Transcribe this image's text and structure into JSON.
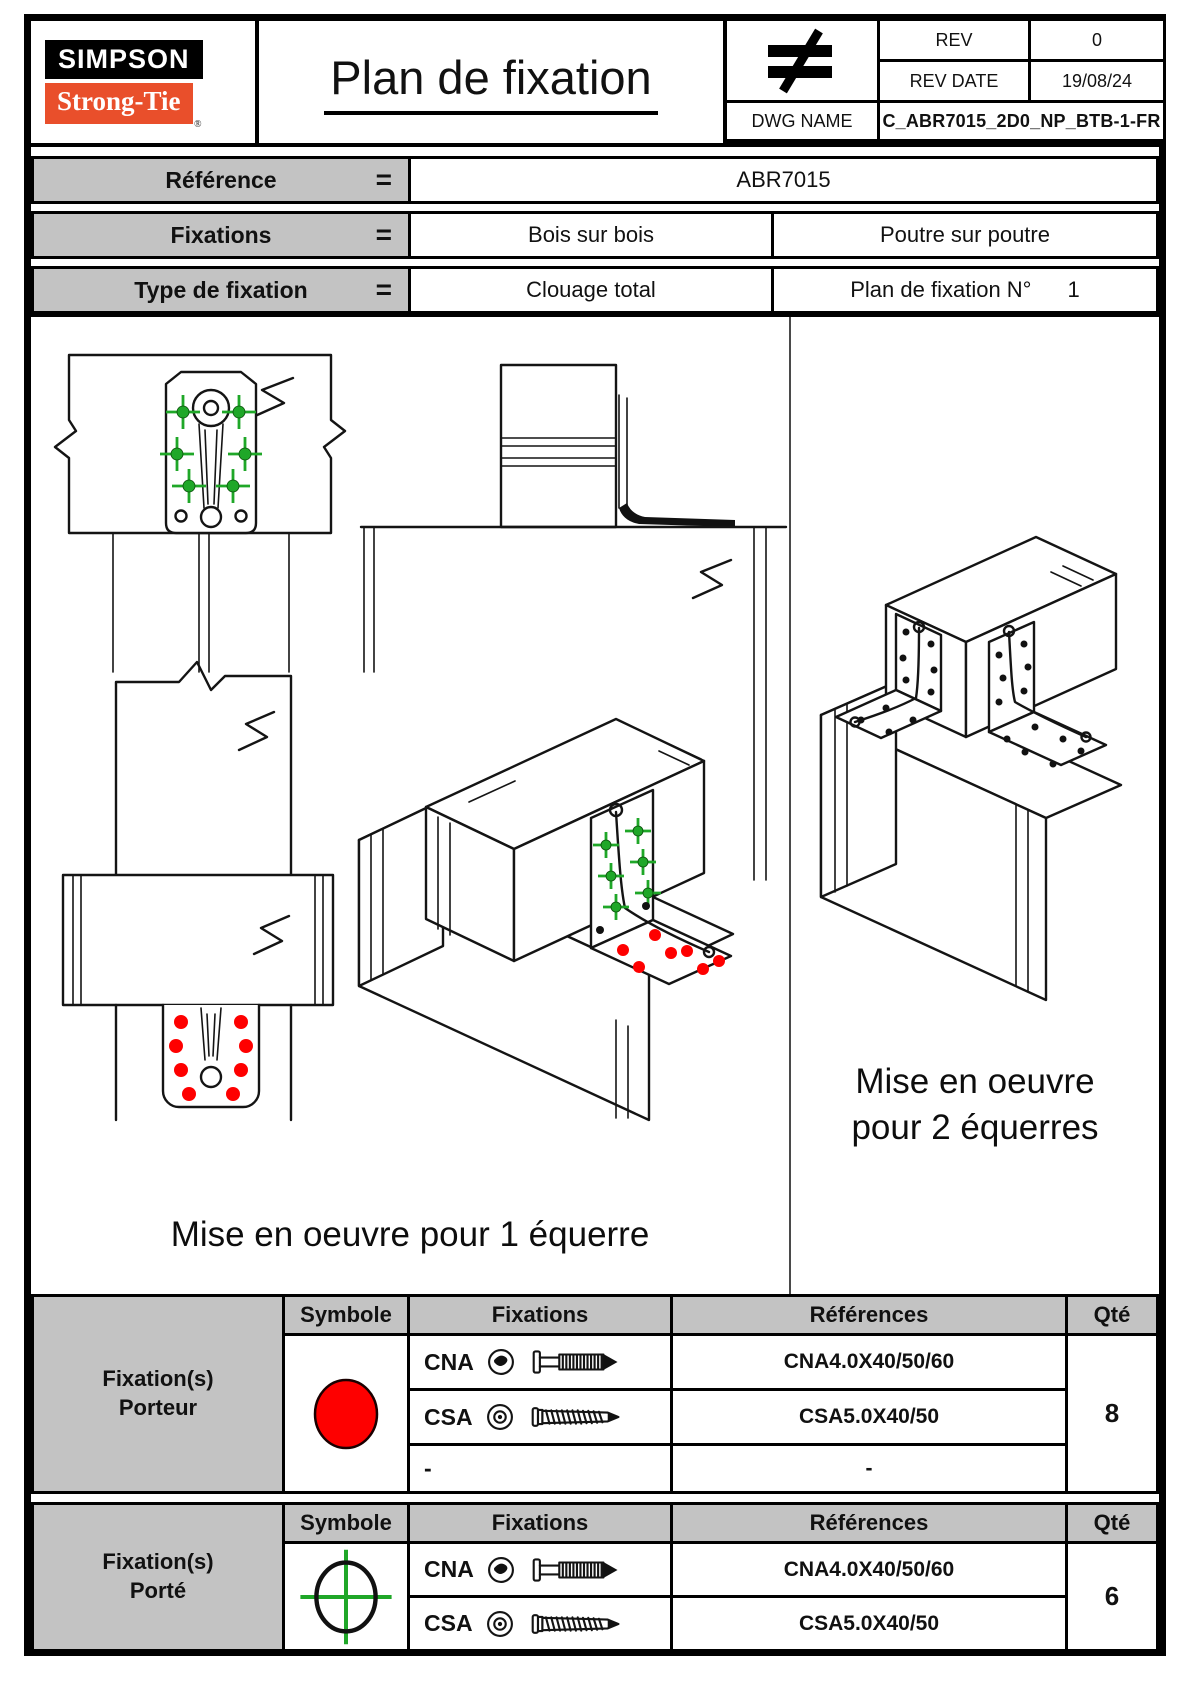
{
  "header": {
    "logo_top": "SIMPSON",
    "logo_bottom": "Strong-Tie",
    "logo_reg": "®",
    "title": "Plan de fixation",
    "revision_symbol": "≠",
    "rev_label": "REV",
    "rev_value": "0",
    "rev_date_label": "REV DATE",
    "rev_date_value": "19/08/24",
    "dwg_label": "DWG NAME",
    "dwg_value": "C_ABR7015_2D0_NP_BTB-1-FR"
  },
  "info": {
    "rows": [
      {
        "label": "Référence",
        "eq": "=",
        "values": [
          "ABR7015"
        ]
      },
      {
        "label": "Fixations",
        "eq": "=",
        "values": [
          "Bois sur bois",
          "Poutre sur poutre"
        ]
      },
      {
        "label": "Type de fixation",
        "eq": "=",
        "values": [
          "Clouage total"
        ],
        "extra_label": "Plan de fixation N°",
        "extra_value": "1"
      }
    ]
  },
  "drawings": {
    "caption_left": "Mise en oeuvre pour 1 équerre",
    "caption_right_line1": "Mise en oeuvre",
    "caption_right_line2": "pour 2 équerres"
  },
  "tables": [
    {
      "row_label_line1": "Fixation(s)",
      "row_label_line2": "Porteur",
      "headers": [
        "Symbole",
        "Fixations",
        "Références",
        "Qté"
      ],
      "symbol": "red-circle",
      "rows": [
        {
          "fix": "CNA",
          "ref": "CNA4.0X40/50/60"
        },
        {
          "fix": "CSA",
          "ref": "CSA5.0X40/50"
        },
        {
          "fix": "-",
          "ref": "-"
        }
      ],
      "qty": "8"
    },
    {
      "row_label_line1": "Fixation(s)",
      "row_label_line2": "Porté",
      "headers": [
        "Symbole",
        "Fixations",
        "Références",
        "Qté"
      ],
      "symbol": "green-crosshair",
      "rows": [
        {
          "fix": "CNA",
          "ref": "CNA4.0X40/50/60"
        },
        {
          "fix": "CSA",
          "ref": "CSA5.0X40/50"
        }
      ],
      "qty": "6"
    }
  ],
  "colors": {
    "accent_orange": "#e94f2b",
    "table_gray": "#c3c3c3",
    "marker_red": "#fe0000",
    "marker_green": "#1fa728"
  }
}
